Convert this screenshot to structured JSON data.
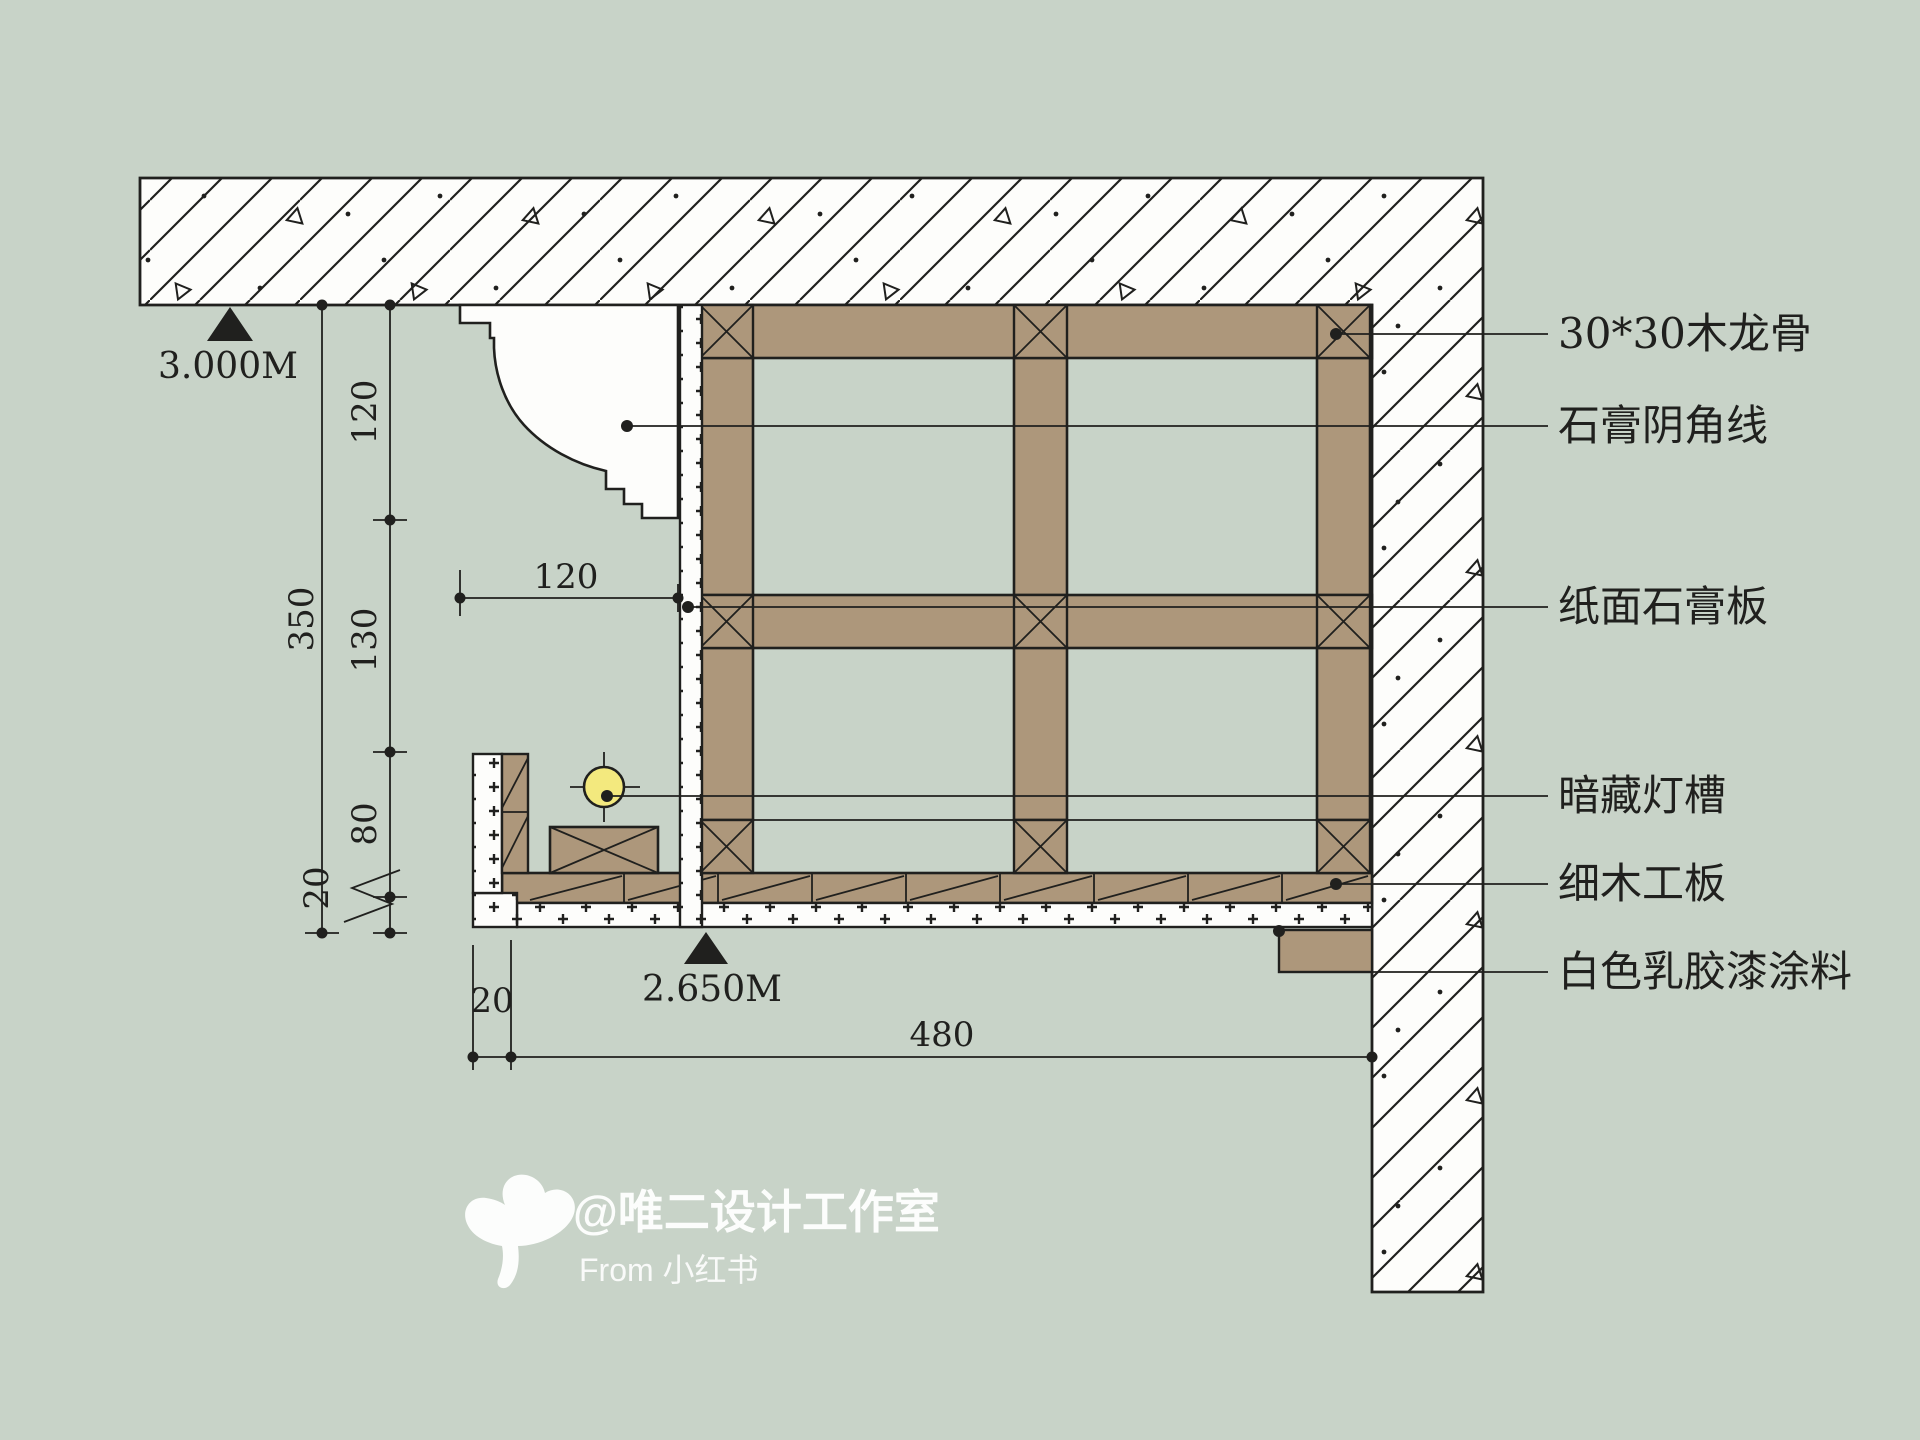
{
  "colors": {
    "background": "#c8d3c8",
    "line": "#20201e",
    "wood": "#ad977b",
    "paper": "#fdfdfb",
    "lamp_yellow": "#f3e97e",
    "watermark_white": "#ffffff"
  },
  "annotations": {
    "items": [
      {
        "label": "30*30木龙骨"
      },
      {
        "label": "石膏阴角线"
      },
      {
        "label": "纸面石膏板"
      },
      {
        "label": "暗藏灯槽"
      },
      {
        "label": "细木工板"
      },
      {
        "label": "白色乳胶漆涂料"
      }
    ]
  },
  "levels": {
    "top": "3.000M",
    "bottom": "2.650M"
  },
  "dims": {
    "d120v": "120",
    "d130": "130",
    "d80": "80",
    "d20_left": "20",
    "d350": "350",
    "d120h": "120",
    "d20_bottom": "20",
    "d480": "480"
  },
  "watermark": {
    "handle": "@唯二设计工作室",
    "source": "From 小红书"
  }
}
